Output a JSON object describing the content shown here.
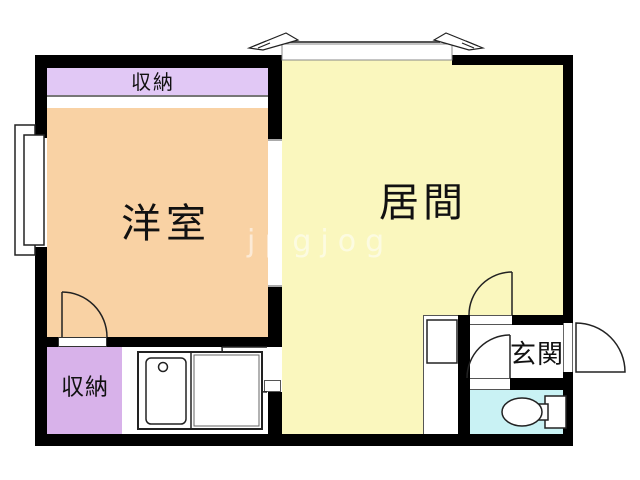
{
  "plan": {
    "type": "japanese-apartment-floor-plan",
    "rooms": {
      "western_room": {
        "label": "洋室",
        "color": "#F9D2A4"
      },
      "living_room": {
        "label": "居間",
        "color": "#FAF7BE"
      },
      "closet_top": {
        "label": "収納",
        "color": "#E1C8F5"
      },
      "closet_bottom": {
        "label": "収納",
        "color": "#D8B2EA"
      },
      "entrance": {
        "label": "玄関",
        "color": "#FFFFFF"
      },
      "toilet_room": {
        "label": "",
        "color": "#C9F2F4"
      }
    },
    "wall_color": "#000000",
    "fixtures": [
      "kitchen-sink-counter",
      "faucet",
      "toilet-bowl",
      "toilet-tank",
      "shoe-cabinet",
      "bay-window-left-wall",
      "sliding-window-top",
      "window-direction-arrows"
    ],
    "doors": [
      "western-room-swing-door",
      "kitchen-living-swing-door",
      "living-entrance-swing-door",
      "toilet-swing-door",
      "front-door-outward"
    ]
  },
  "watermark": {
    "text": "jpgjog"
  }
}
